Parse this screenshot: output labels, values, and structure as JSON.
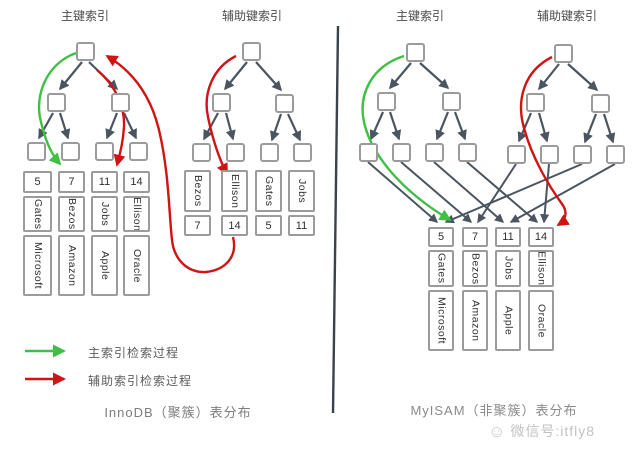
{
  "left_panel": {
    "primary_index_title": "主键索引",
    "secondary_index_title": "辅助键索引",
    "caption": "InnoDB（聚簇）表分布",
    "records": [
      {
        "key": "5",
        "name": "Gates",
        "company": "Microsoft"
      },
      {
        "key": "7",
        "name": "Bezos",
        "company": "Amazon"
      },
      {
        "key": "11",
        "name": "Jobs",
        "company": "Apple"
      },
      {
        "key": "14",
        "name": "Ellison",
        "company": "Oracle"
      }
    ],
    "secondary_leaves": [
      {
        "name": "Bezos",
        "key": "7"
      },
      {
        "name": "Ellison",
        "key": "14"
      },
      {
        "name": "Gates",
        "key": "5"
      },
      {
        "name": "Jobs",
        "key": "11"
      }
    ]
  },
  "right_panel": {
    "primary_index_title": "主键索引",
    "secondary_index_title": "辅助键索引",
    "caption": "MyISAM（非聚簇）表分布",
    "records": [
      {
        "key": "5",
        "name": "Gates",
        "company": "Microsoft"
      },
      {
        "key": "7",
        "name": "Bezos",
        "company": "Amazon"
      },
      {
        "key": "11",
        "name": "Jobs",
        "company": "Apple"
      },
      {
        "key": "14",
        "name": "Ellison",
        "company": "Oracle"
      }
    ]
  },
  "legend": {
    "primary": {
      "label": "主索引检索过程",
      "color": "#3fbf44"
    },
    "secondary": {
      "label": "辅助索引检索过程",
      "color": "#cf1414"
    }
  },
  "watermark": {
    "icon": "smiley-icon",
    "text": "微信号:itfly8"
  },
  "colors": {
    "tree_line": "#4b5560",
    "box_border": "#9b9b9b",
    "primary_path_green": "#3fbf44",
    "secondary_path_red": "#cf1414",
    "divider": "#3a424b"
  }
}
